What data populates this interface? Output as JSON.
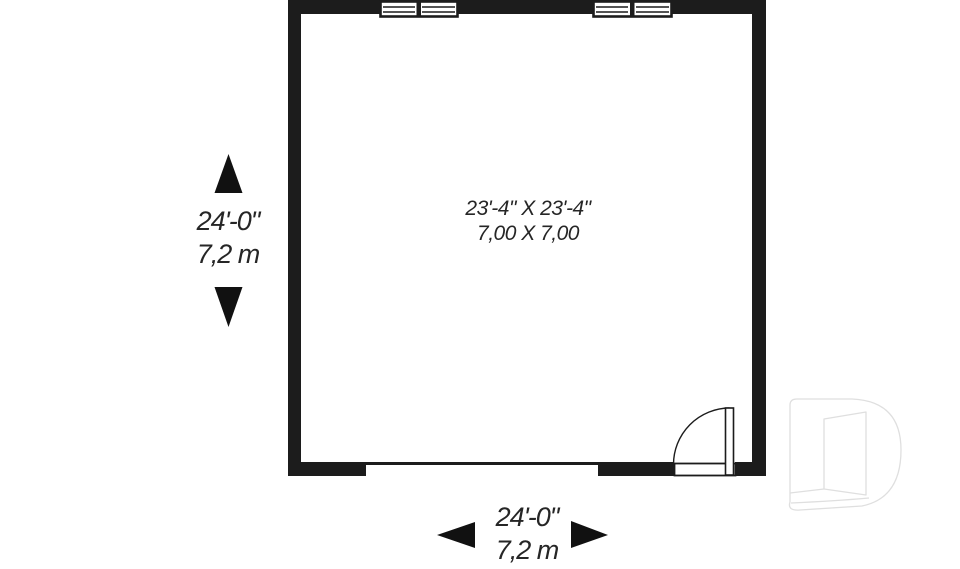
{
  "room": {
    "size_imperial": "23'-4\" X 23'-4\"",
    "size_metric": "7,00 X 7,00"
  },
  "dimensions": {
    "vertical": {
      "imperial": "24'-0\"",
      "metric": "7,2 m"
    },
    "horizontal": {
      "imperial": "24'-0\"",
      "metric": "7,2 m"
    }
  },
  "icons": {
    "arrow_up": "dimension-arrow-up",
    "arrow_down": "dimension-arrow-down",
    "arrow_left": "dimension-arrow-left",
    "arrow_right": "dimension-arrow-right",
    "watermark": "drummond-d-logo"
  },
  "colors": {
    "wall": "#1c1c1c",
    "text": "#262626",
    "watermark_outline": "#dfdfdf",
    "background": "#ffffff"
  }
}
